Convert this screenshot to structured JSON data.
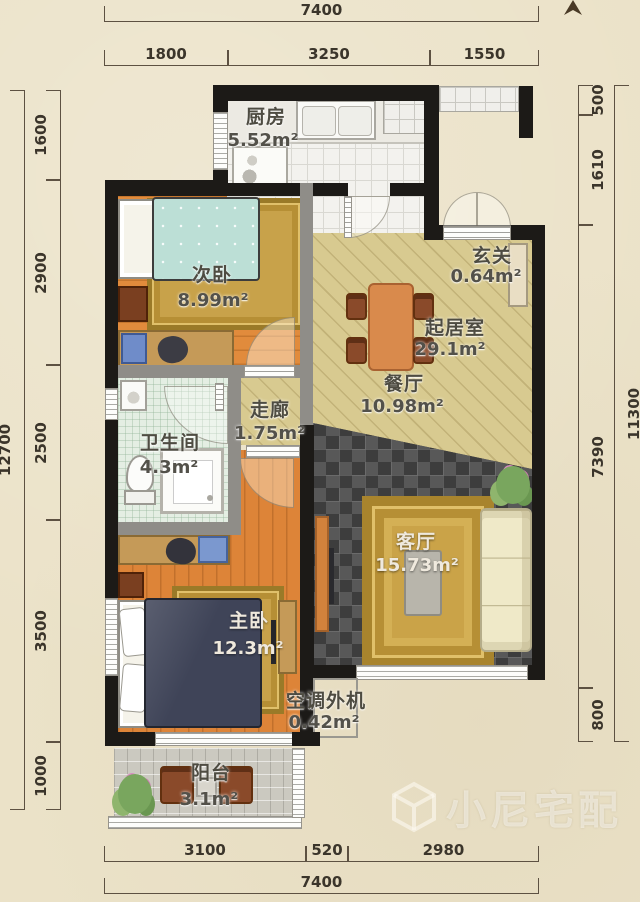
{
  "dimensions": {
    "top": {
      "total": "7400",
      "segments": [
        "1800",
        "3250",
        "1550"
      ]
    },
    "left": {
      "total": "12700",
      "segments": [
        "1600",
        "2900",
        "2500",
        "3500",
        "1000"
      ]
    },
    "right": {
      "total": "11300",
      "segments": [
        "500",
        "1610",
        "7390",
        "800"
      ]
    },
    "bottom": {
      "total": "7400",
      "segments": [
        "3100",
        "520",
        "2980"
      ]
    }
  },
  "rooms": [
    {
      "id": "kitchen",
      "name": "厨房",
      "area": "5.52m²"
    },
    {
      "id": "secondary-bedroom",
      "name": "次卧",
      "area": "8.99m²"
    },
    {
      "id": "entryway",
      "name": "玄关",
      "area": "0.64m²"
    },
    {
      "id": "living-area",
      "name": "起居室",
      "area": "29.1m²"
    },
    {
      "id": "dining-room",
      "name": "餐厅",
      "area": "10.98m²"
    },
    {
      "id": "corridor",
      "name": "走廊",
      "area": "1.75m²"
    },
    {
      "id": "bathroom",
      "name": "卫生间",
      "area": "4.3m²"
    },
    {
      "id": "living-room",
      "name": "客厅",
      "area": "15.73m²"
    },
    {
      "id": "master-bedroom",
      "name": "主卧",
      "area": "12.3m²"
    },
    {
      "id": "ac-outdoor-unit",
      "name": "空调外机",
      "area": "0.42m²"
    },
    {
      "id": "balcony",
      "name": "阳台",
      "area": "3.1m²"
    }
  ],
  "watermark": {
    "text": "小尼宅配"
  },
  "colors": {
    "paper": "#ebe2c8",
    "wall": "#1c1a17",
    "wall_grey": "#8f8d88",
    "wood_floor": "#dd8438",
    "khaki_floor": "#d8ca90",
    "dark_tile": "#4c4c4c",
    "rug_gold": "#caa348",
    "bed_teal": "#bcdfd6",
    "bed_navy": "#3f4458",
    "sofa_cream": "#efe9c8"
  }
}
